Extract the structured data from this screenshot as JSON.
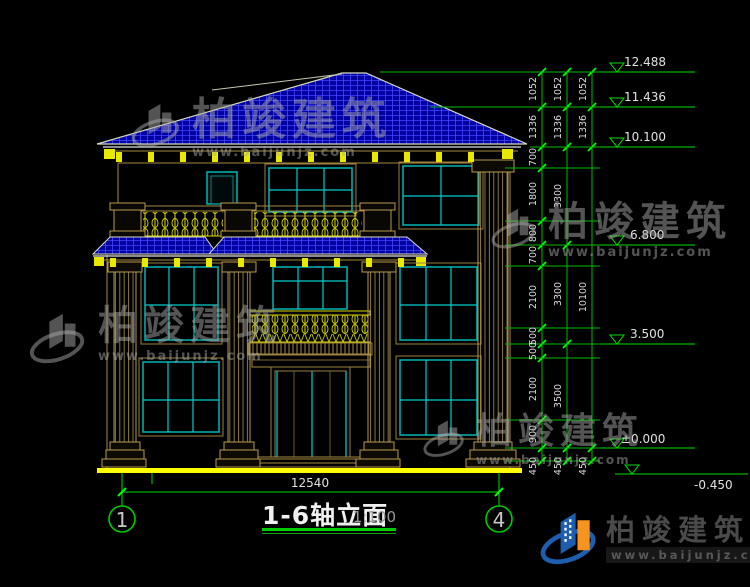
{
  "drawing": {
    "title": "1-6轴立面",
    "scale": "1:100",
    "total_width_dim": "12540",
    "axis_left": "1",
    "axis_right": "4",
    "levels": [
      "12.488",
      "11.436",
      "10.100",
      "6.800",
      "3.500",
      "±0.000",
      "-0.450"
    ],
    "dim_chain_inner": [
      "1052",
      "1336",
      "700",
      "1800",
      "800",
      "700",
      "2100",
      "500",
      "500",
      "2100",
      "900",
      "450"
    ],
    "dim_chain_middle": [
      "1052",
      "1336",
      "3300",
      "3300",
      "3500",
      "450"
    ],
    "dim_chain_outer": [
      "1052",
      "1336",
      "10100",
      "450"
    ]
  },
  "watermark": {
    "name": "柏竣建筑",
    "url": "www.baijunjz.com"
  },
  "logo": {
    "name": "柏竣建筑",
    "url": "www.baijunjz.com"
  },
  "colors": {
    "background": "#000000",
    "roof_tile": "#0000A0",
    "dimension_green": "#00DD00",
    "structure_yellow": "#FFFF00",
    "wood_tan": "#B8954E",
    "window_teal": "#00B4B4"
  }
}
